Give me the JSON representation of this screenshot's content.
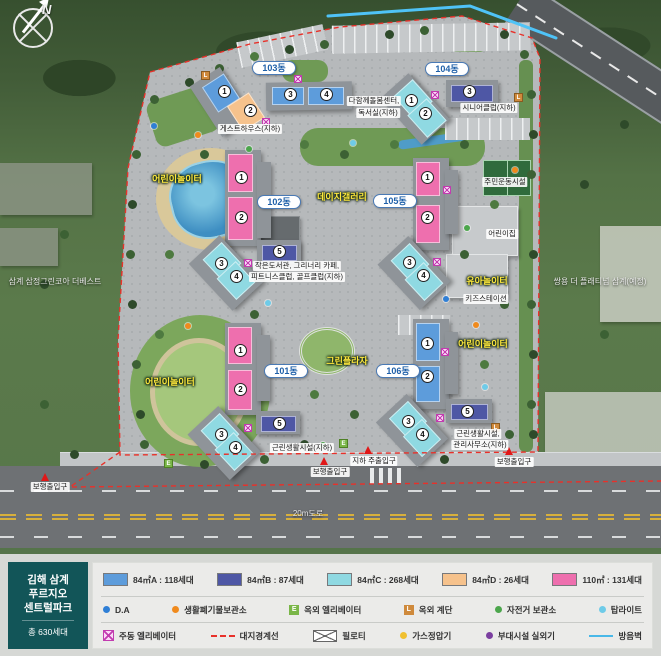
{
  "project": {
    "name_line1": "김해 삼계",
    "name_line2": "푸르지오",
    "name_line3": "센트럴파크",
    "total_households": "총 630세대"
  },
  "map": {
    "compass": "N",
    "road_label": "20m도로",
    "neighbor_left": "삼계 삼정그린코아 더베스트",
    "neighbor_right": "쌍용 더 플래티넘 삼계(예정)",
    "buildings": [
      {
        "name": "103동",
        "units": [
          {
            "no": "1",
            "type": "84A"
          },
          {
            "no": "2",
            "type": "84D"
          },
          {
            "no": "3",
            "type": "84A"
          },
          {
            "no": "4",
            "type": "84A"
          }
        ]
      },
      {
        "name": "104동",
        "units": [
          {
            "no": "1",
            "type": "84C"
          },
          {
            "no": "2",
            "type": "84C"
          },
          {
            "no": "3",
            "type": "84B"
          }
        ]
      },
      {
        "name": "102동",
        "units": [
          {
            "no": "1",
            "type": "110"
          },
          {
            "no": "2",
            "type": "110"
          },
          {
            "no": "3",
            "type": "84C"
          },
          {
            "no": "4",
            "type": "84C"
          },
          {
            "no": "5",
            "type": "84B"
          }
        ]
      },
      {
        "name": "105동",
        "units": [
          {
            "no": "1",
            "type": "110"
          },
          {
            "no": "2",
            "type": "110"
          },
          {
            "no": "3",
            "type": "84C"
          },
          {
            "no": "4",
            "type": "84C"
          }
        ]
      },
      {
        "name": "101동",
        "units": [
          {
            "no": "1",
            "type": "110"
          },
          {
            "no": "2",
            "type": "110"
          },
          {
            "no": "3",
            "type": "84C"
          },
          {
            "no": "4",
            "type": "84C"
          },
          {
            "no": "5",
            "type": "84B"
          }
        ]
      },
      {
        "name": "106동",
        "units": [
          {
            "no": "1",
            "type": "84A"
          },
          {
            "no": "2",
            "type": "84A"
          },
          {
            "no": "3",
            "type": "84C"
          },
          {
            "no": "4",
            "type": "84C"
          },
          {
            "no": "5",
            "type": "84B"
          }
        ]
      }
    ],
    "labels": {
      "guesthouse": "게스트하우스(지하)",
      "care_center_line1": "다함께돌봄센터,",
      "care_center_line2": "독서실(지하)",
      "senior_club": "시니어클럽(지하)",
      "sports_facility": "주민운동시설",
      "daycare": "어린이집",
      "kids_station": "키즈스테이션",
      "library_line1": "작은도서관, 그리너리 카페,",
      "library_line2": "피트니스클럽, 골프클럽(지하)",
      "retail": "근린생활시설(지하)",
      "retail2_line1": "근린생활시설,",
      "retail2_line2": "관리사무소(지하)",
      "pedestrian_entrance": "보행출입구",
      "underground_entrance": "지하 주출입구",
      "kids_playground": "어린이놀이터",
      "toddler_playground": "유아놀이터",
      "green_plaza": "그린플라자",
      "daisy_gallery": "데이지갤러리"
    }
  },
  "legend": {
    "unit_types": [
      {
        "label": "84㎡A : 118세대",
        "color": "#5d9cdb"
      },
      {
        "label": "84㎡B : 87세대",
        "color": "#4e57a5"
      },
      {
        "label": "84㎡C : 268세대",
        "color": "#8fd9e2"
      },
      {
        "label": "84㎡D : 26세대",
        "color": "#f6c28c"
      },
      {
        "label": "110㎡ : 131세대",
        "color": "#ee6fae"
      }
    ],
    "row2": [
      {
        "label": "D.A",
        "color": "#2f7fd6"
      },
      {
        "label": "생활폐기물보관소",
        "color": "#f08a1d"
      },
      {
        "label": "옥외 엘리베이터",
        "color": "#7ab648"
      },
      {
        "label": "옥외 계단",
        "color": "#cf8a3c"
      },
      {
        "label": "자전거 보관소",
        "color": "#4ca64c"
      },
      {
        "label": "탑라이트",
        "color": "#6ecbe8"
      }
    ],
    "row3": [
      {
        "label": "주동 엘리베이터",
        "color": "#e75fd0"
      },
      {
        "label": "대지경계선",
        "color": "#e8312a"
      },
      {
        "label": "필로티",
        "color": "#666666"
      },
      {
        "label": "가스정압기",
        "color": "#f0c030"
      },
      {
        "label": "부대시설 실외기",
        "color": "#7b3fa0"
      },
      {
        "label": "방음벽",
        "color": "#49b8e8"
      }
    ],
    "icon_letters": {
      "elevator": "E",
      "stair": "L"
    }
  }
}
